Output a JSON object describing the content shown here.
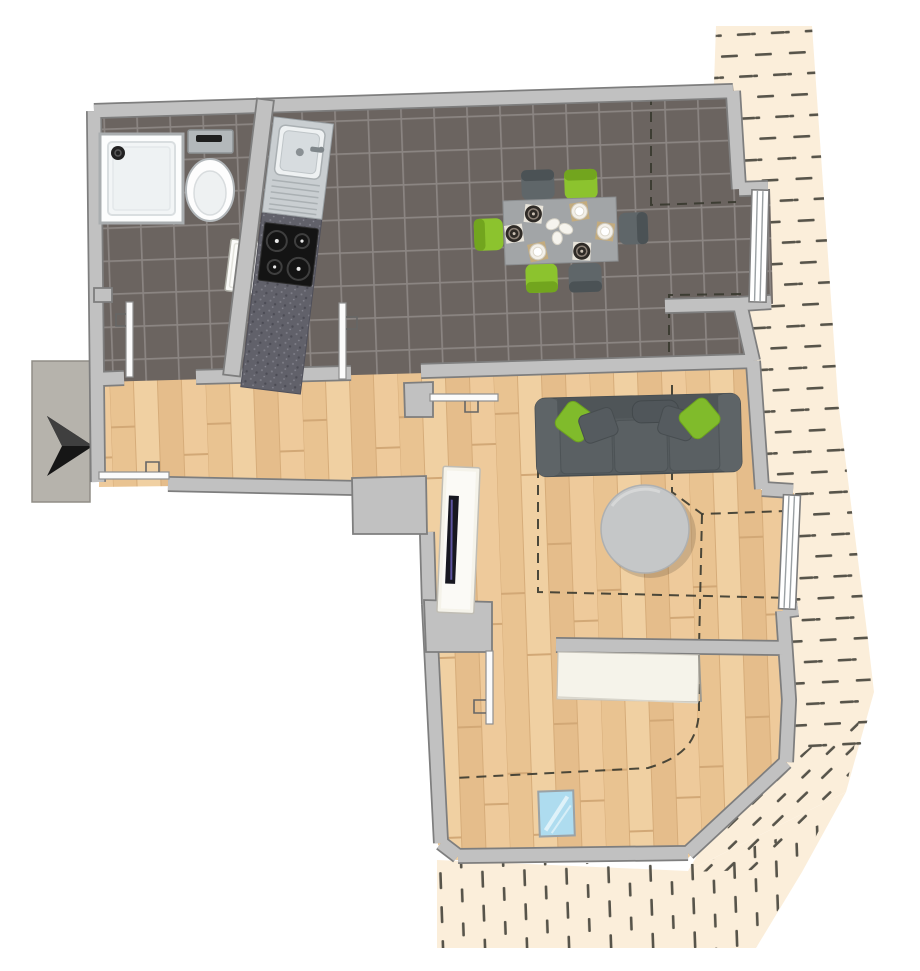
{
  "title": "attic-apartment-floor-plan",
  "plan": {
    "type": "residential floor plan, top-down 3D render, no text labels",
    "rooms": [
      {
        "id": "bathroom",
        "floor": "dark-gray-tile",
        "position": "top-left",
        "fixtures": [
          "shower-tray",
          "toilet",
          "wall-washbasin"
        ]
      },
      {
        "id": "kitchen-dining",
        "floor": "dark-gray-tile",
        "position": "top-right",
        "fixtures": [
          "kitchenette-counter",
          "steel-sink",
          "cooktop-4-burners",
          "dining-table-6-chairs"
        ]
      },
      {
        "id": "hallway",
        "floor": "light-wood",
        "position": "middle-left",
        "fixtures": [
          "entrance-door"
        ]
      },
      {
        "id": "living-room",
        "floor": "light-wood",
        "position": "middle-right",
        "fixtures": [
          "sofa-3-seat",
          "round-coffee-table",
          "tv-lowboard"
        ]
      },
      {
        "id": "bedroom",
        "floor": "light-wood",
        "position": "bottom",
        "fixtures": [
          "sideboard",
          "skylight-roof-window"
        ]
      },
      {
        "id": "terrace",
        "floor": "cream-hatched",
        "position": "right-and-bottom-outside"
      },
      {
        "id": "stair-landing",
        "floor": "concrete-gray",
        "position": "left-outside"
      }
    ],
    "openings": {
      "doors": [
        {
          "id": "entrance-door",
          "wall": "hallway-south",
          "state": "open"
        },
        {
          "id": "bathroom-door",
          "wall": "bathroom-south",
          "state": "open"
        },
        {
          "id": "kitchen-door",
          "wall": "kitchen-south",
          "state": "open"
        },
        {
          "id": "living-room-door",
          "wall": "living-north",
          "state": "open"
        },
        {
          "id": "bedroom-door",
          "wall": "bedroom-north",
          "state": "open"
        }
      ],
      "windows": [
        {
          "id": "dining-terrace-window",
          "wall": "east"
        },
        {
          "id": "living-terrace-window",
          "wall": "east"
        }
      ]
    },
    "furniture": {
      "dining_chairs": {
        "count": 6,
        "green": 3,
        "gray": 3
      },
      "place_settings": {
        "count": 6,
        "dark_plates": 3,
        "white_bowls": 3
      },
      "sofa_pillows": {
        "green": 2,
        "gray": 2,
        "center": 1
      }
    },
    "annotations": {
      "entrance_arrow": "black arrow at stair landing pointing right into apartment",
      "dashed_interior_lines": "sloped-roof height boundary lines",
      "dashed_hatching": "open terrace decking around right and bottom"
    }
  },
  "colors": {
    "background": "#ffffff",
    "wall_fill": "#c1c1c1",
    "wall_edge": "#7e7e7e",
    "tile_floor": "#6b6460",
    "tile_grout": "#8b8582",
    "wood_floor": "#ecc998",
    "terrace": "#fbeeda",
    "terrace_dash": "#57544a",
    "landing": "#b6b3ac",
    "arrow": "#161616",
    "table_gray": "#a2a5a7",
    "chair_green": "#8cc32e",
    "chair_gray": "#5f6669",
    "sofa_gray": "#565c5f",
    "pillow_green": "#80bb2b",
    "coffee_table": "#c5c7c8",
    "counter_dark": "#61616a",
    "cooktop": "#141414",
    "sink_steel": "#c9ced1",
    "sideboard_white": "#f5f3ea",
    "skylight": "#aedcef",
    "roofline_dash": "#38382f"
  }
}
